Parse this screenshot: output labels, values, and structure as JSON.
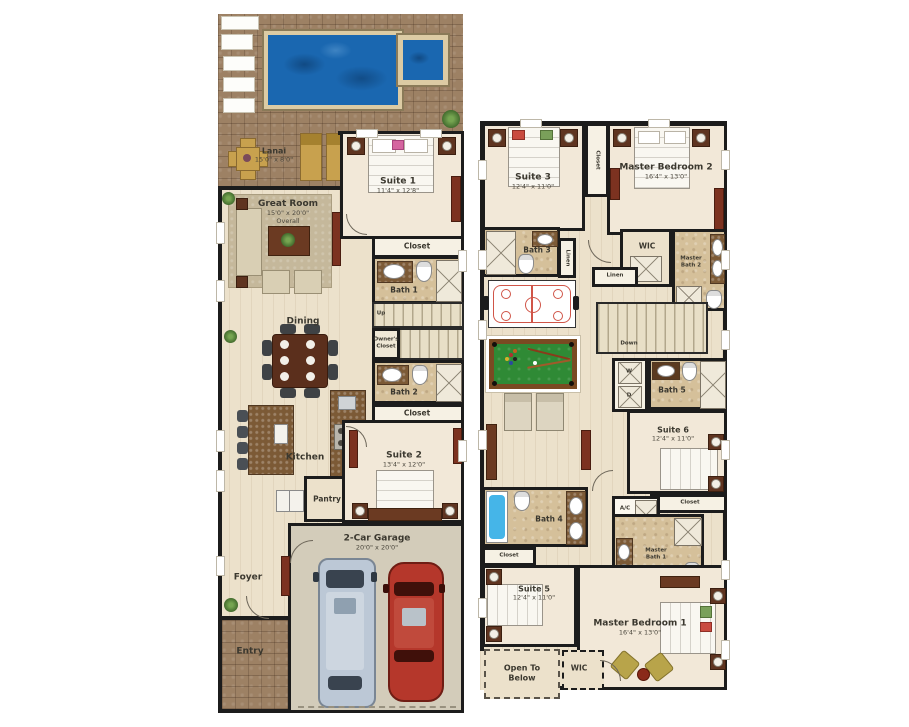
{
  "floor1": {
    "lanai": {
      "name": "Lanai",
      "dims": "15'0\" x 8'0\""
    },
    "great_room": {
      "name": "Great Room",
      "dims": "15'0\" x 20'0\"",
      "note": "Overall"
    },
    "suite1": {
      "name": "Suite 1",
      "dims": "11'4\" x 12'8\""
    },
    "closet1": "Closet",
    "bath1": "Bath 1",
    "up": "Up",
    "owners_closet": {
      "l1": "Owner's",
      "l2": "Closet"
    },
    "dining": "Dining",
    "bath2": "Bath 2",
    "closet2": "Closet",
    "kitchen": "Kitchen",
    "pantry": "Pantry",
    "suite2": {
      "name": "Suite 2",
      "dims": "13'4\" x 12'0\""
    },
    "garage": {
      "name": "2-Car Garage",
      "dims": "20'0\" x 20'0\""
    },
    "foyer": "Foyer",
    "entry": "Entry"
  },
  "floor2": {
    "suite3": {
      "name": "Suite 3",
      "dims": "12'4\" x 11'0\""
    },
    "closet3": "Closet",
    "master_bedroom2": {
      "name": "Master Bedroom 2",
      "dims": "16'4\" x 13'0\""
    },
    "bath3": "Bath 3",
    "linen1": "Linen",
    "wic2": "WIC",
    "master_bath2": {
      "l1": "Master",
      "l2": "Bath 2"
    },
    "linen2": "Linen",
    "down": "Down",
    "washer": "W",
    "dryer": "D",
    "bath5": "Bath 5",
    "suite6": {
      "name": "Suite 6",
      "dims": "12'4\" x 11'0\""
    },
    "closet6": "Closet",
    "ac": "A/C",
    "bath4": "Bath 4",
    "closet4": "Closet",
    "master_bath1": {
      "l1": "Master",
      "l2": "Bath 1"
    },
    "suite5": {
      "name": "Suite 5",
      "dims": "12'4\" x 11'0\""
    },
    "master_bedroom1": {
      "name": "Master Bedroom 1",
      "dims": "16'4\" x 13'0\""
    },
    "open_to_below": {
      "l1": "Open To",
      "l2": "Below"
    },
    "wic1": "WIC"
  },
  "colors": {
    "wall": "#1c1c1c",
    "pool_water": "#1a67b0",
    "deck_brick": "#9d8164",
    "floor_cream": "#ece1cb",
    "bedroom_floor": "#f2e8d8",
    "bath_tan": "#d5c09a",
    "garage_floor": "#d3ccba",
    "pool_table_felt": "#2f8a35",
    "car_red": "#b5372b",
    "suv_silver": "#bcc8d6",
    "tub_blue": "#45b5e8"
  }
}
